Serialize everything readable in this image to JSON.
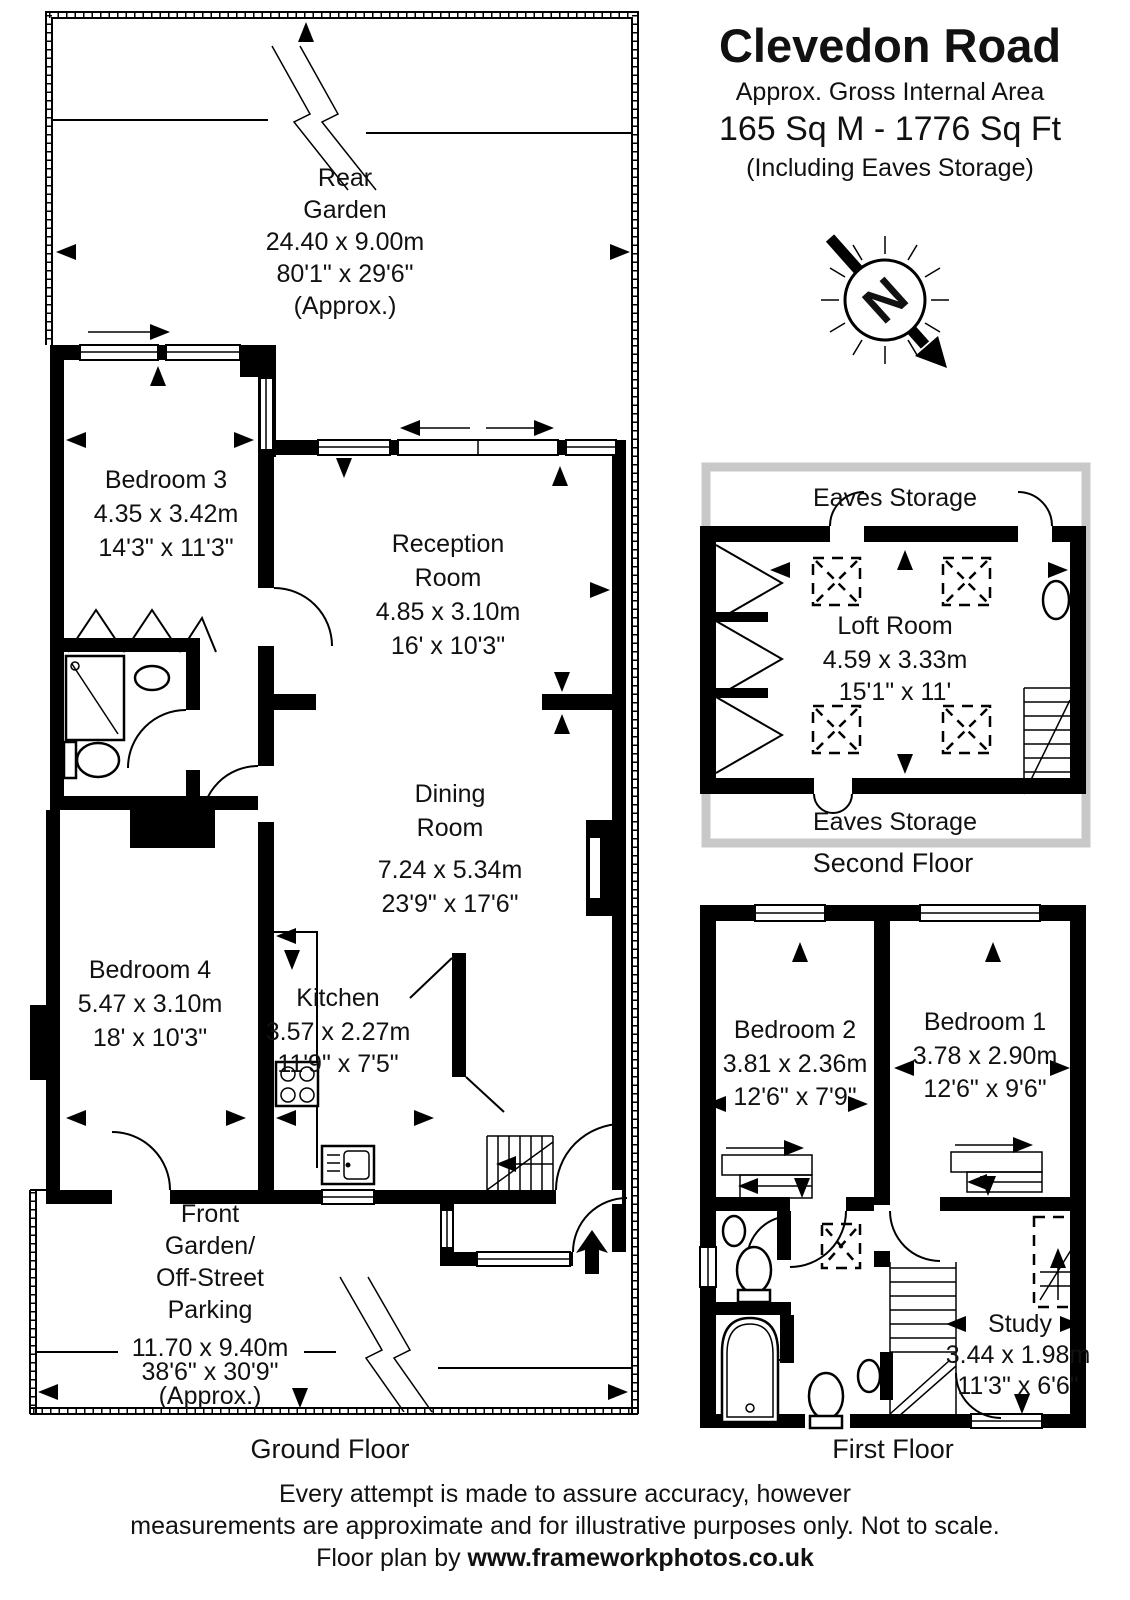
{
  "header": {
    "title": "Clevedon Road",
    "subtitle": "Approx. Gross Internal Area",
    "area": "165 Sq M  -  1776 Sq Ft",
    "area_note": "(Including Eaves Storage)"
  },
  "compass": {
    "letter": "N"
  },
  "ground_floor": {
    "label": "Ground Floor",
    "rear_garden": {
      "line1": "Rear",
      "line2": "Garden",
      "dims_m": "24.40 x 9.00m",
      "dims_ft": "80'1\" x 29'6\"",
      "note": "(Approx.)"
    },
    "bedroom3": {
      "name": "Bedroom 3",
      "dims_m": "4.35 x 3.42m",
      "dims_ft": "14'3\" x 11'3\""
    },
    "reception": {
      "line1": "Reception",
      "line2": "Room",
      "dims_m": "4.85 x 3.10m",
      "dims_ft": "16' x 10'3\""
    },
    "dining": {
      "line1": "Dining",
      "line2": "Room",
      "dims_m": "7.24 x 5.34m",
      "dims_ft": "23'9\" x 17'6\""
    },
    "bedroom4": {
      "name": "Bedroom 4",
      "dims_m": "5.47 x 3.10m",
      "dims_ft": "18' x 10'3\""
    },
    "kitchen": {
      "name": "Kitchen",
      "dims_m": "3.57 x 2.27m",
      "dims_ft": "11'9\" x 7'5\""
    },
    "front_garden": {
      "line1": "Front",
      "line2": "Garden/",
      "line3": "Off-Street",
      "line4": "Parking",
      "dims_m": "11.70 x 9.40m",
      "dims_ft": "38'6\" x 30'9\"",
      "note": "(Approx.)"
    }
  },
  "second_floor": {
    "label": "Second Floor",
    "eaves_top": "Eaves Storage",
    "eaves_bottom": "Eaves Storage",
    "loft": {
      "name": "Loft Room",
      "dims_m": "4.59 x 3.33m",
      "dims_ft": "15'1\" x 11'"
    }
  },
  "first_floor": {
    "label": "First Floor",
    "bedroom2": {
      "name": "Bedroom 2",
      "dims_m": "3.81 x 2.36m",
      "dims_ft": "12'6\" x 7'9\""
    },
    "bedroom1": {
      "name": "Bedroom 1",
      "dims_m": "3.78 x 2.90m",
      "dims_ft": "12'6\" x 9'6\""
    },
    "study": {
      "name": "Study",
      "dims_m": "3.44 x 1.98m",
      "dims_ft": "11'3\" x 6'6\""
    }
  },
  "footer": {
    "line1": "Every attempt is made to assure accuracy, however",
    "line2": "measurements are approximate and for illustrative purposes only. Not to scale.",
    "credit_prefix": "Floor plan by  ",
    "credit_url": "www.frameworkphotos.co.uk"
  },
  "colors": {
    "wall": "#000000",
    "eaves_outline": "#c8c8c8",
    "background": "#ffffff"
  }
}
